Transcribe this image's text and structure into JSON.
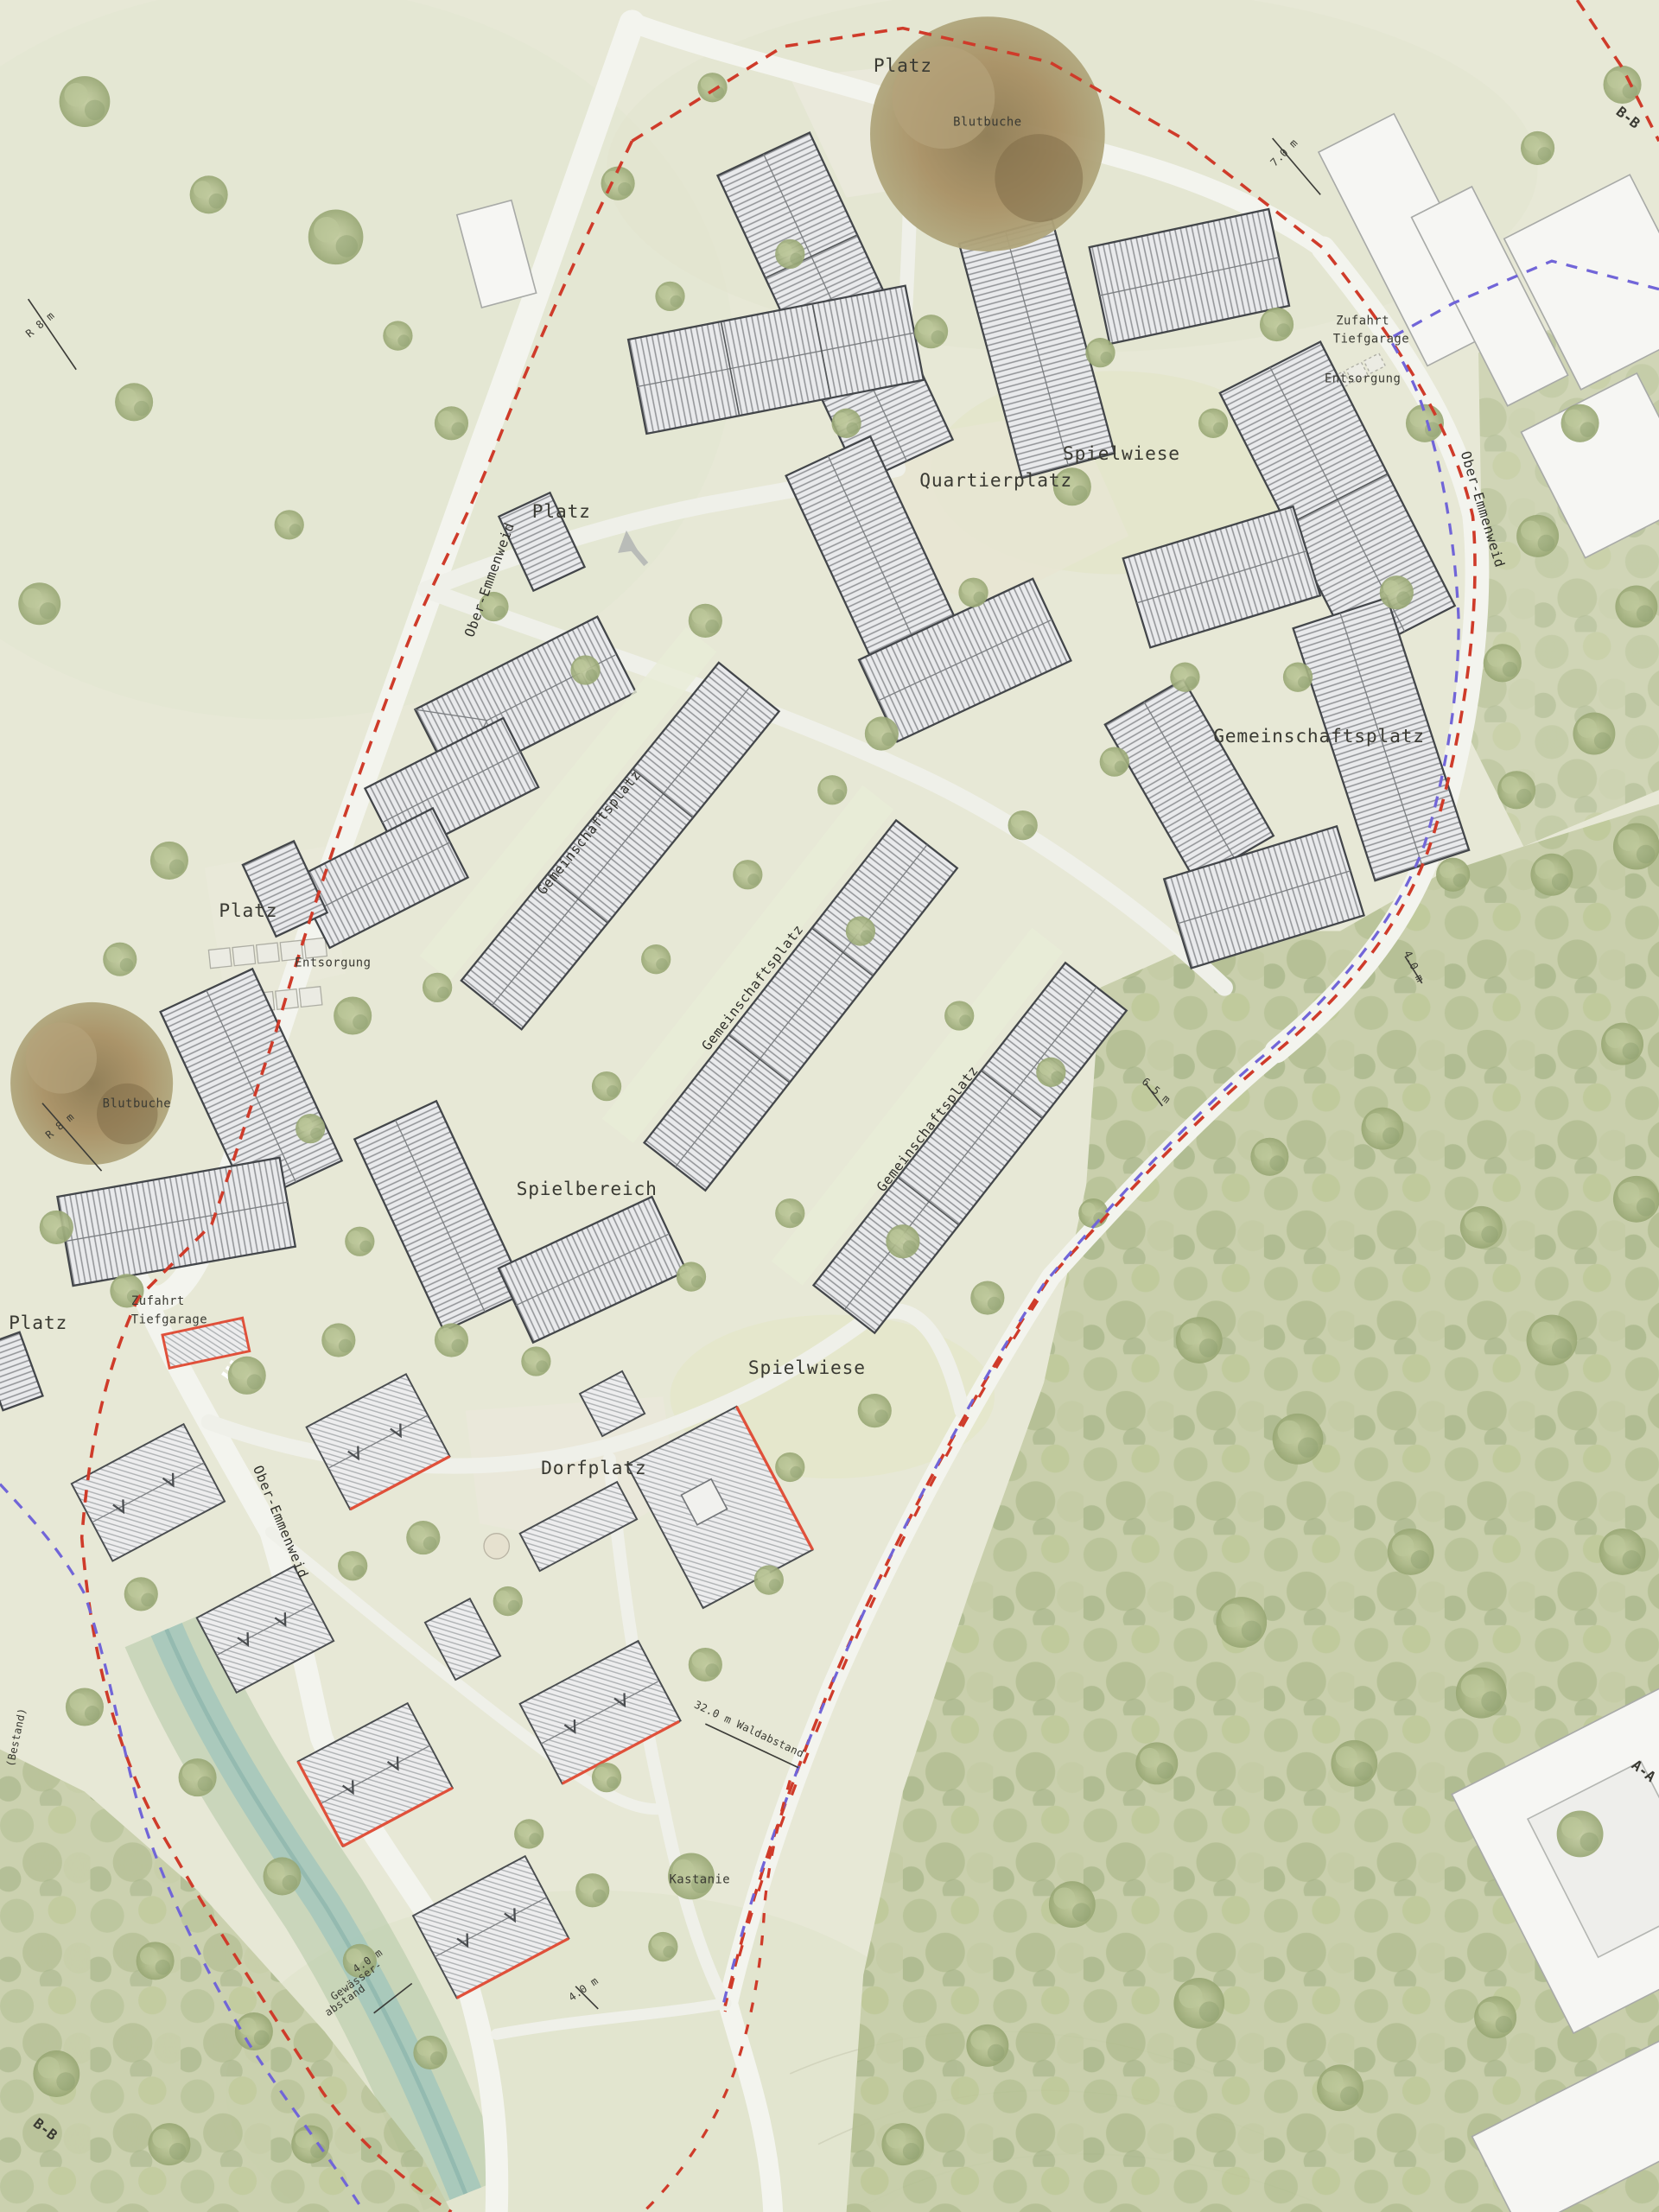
{
  "map": {
    "labels": {
      "platz_north": "Platz",
      "blutbuche_north": "Blutbuche",
      "spielwiese_north": "Spielwiese",
      "quartierplatz": "Quartierplatz",
      "platz_west": "Platz",
      "platz_left": "Platz",
      "platz_southwest": "Platz",
      "entsorgung_left": "Entsorgung",
      "entsorgung_east": "Entsorgung",
      "zufahrt_line1": "Zufahrt",
      "zufahrt_line2": "Tiefgarage",
      "gemeinschaftsplatz_1": "Gemeinschaftsplatz",
      "gemeinschaftsplatz_2": "Gemeinschaftsplatz",
      "gemeinschaftsplatz_3": "Gemeinschaftsplatz",
      "gemeinschaftsplatz_east": "Gemeinschaftsplatz",
      "blutbuche_west": "Blutbuche",
      "spielbereich": "Spielbereich",
      "spielwiese_south": "Spielwiese",
      "dorfplatz": "Dorfplatz",
      "kastanie": "Kastanie",
      "street_west": "Ober-Emmenweid",
      "street_east": "Ober-Emmenweid",
      "street_south": "Ober-Emmenweid",
      "waldabstand": "32.0 m Waldabstand",
      "gewaesser_1": "4.0 m",
      "gewaesser_2": "Gewässer-",
      "gewaesser_3": "abstand",
      "bestand": "(Bestand)",
      "dim_7": "7.0 m",
      "dim_4a": "4.0 m",
      "dim_65": "6.5 m",
      "dim_4b": "4.0 m",
      "dim_r8a": "R 8 m",
      "dim_r8b": "R 8 m",
      "section_bb_top": "B-B",
      "section_bb_bottom": "B-B",
      "section_aa": "A-A"
    },
    "colors": {
      "boundary_red": "#cf3b2a",
      "boundary_blue": "#7165d8",
      "accent_red": "#e0503a",
      "stream": "#9fc4bc",
      "forest": "#c6cda8",
      "road": "#f3f4ee",
      "building_hatch": "#96989b",
      "copper_beech": "#9a8055"
    }
  }
}
